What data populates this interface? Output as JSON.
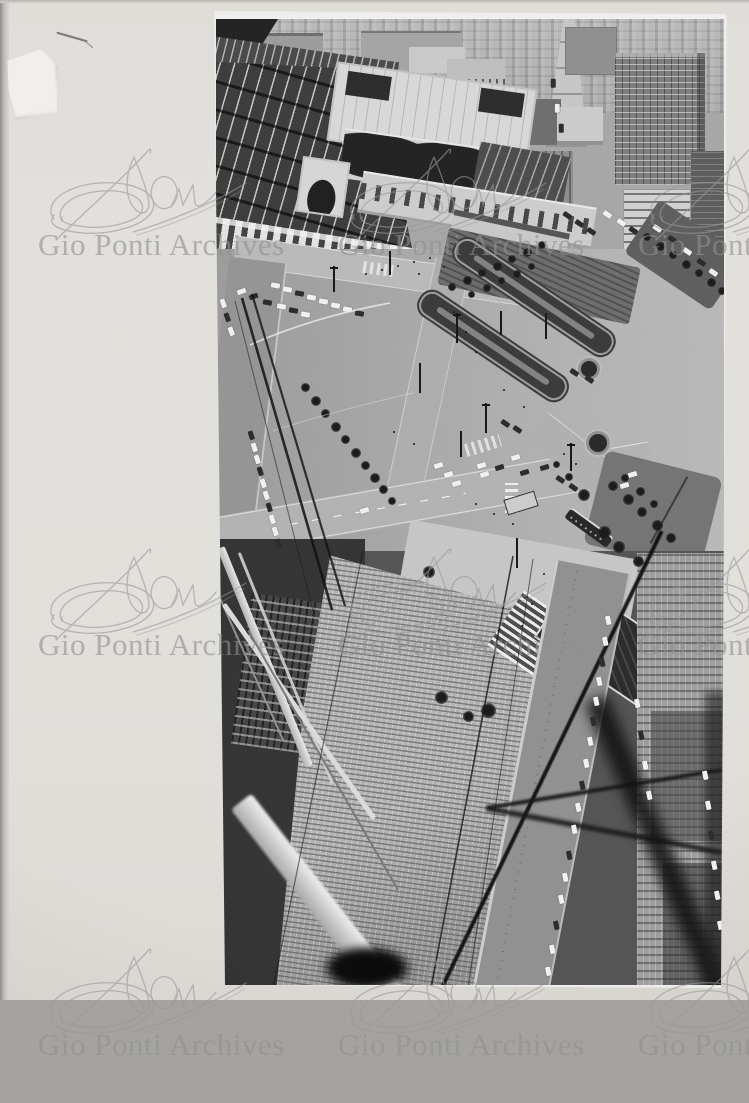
{
  "scan": {
    "mat_color": "#dad7d1",
    "mat_edge_color": "#8f8d8a",
    "background_color": "#a5a3a0"
  },
  "watermark": {
    "text": "Gio Ponti Archives",
    "color": "#8f8f8f",
    "tile_positions": [
      [
        38,
        143
      ],
      [
        338,
        143
      ],
      [
        638,
        143
      ],
      [
        38,
        543
      ],
      [
        338,
        543
      ],
      [
        638,
        543
      ],
      [
        38,
        943
      ],
      [
        338,
        943
      ],
      [
        638,
        943
      ]
    ]
  },
  "photo": {
    "alt": "Black-and-white aerial photograph looking down on Milano Centrale railway station and its forecourt square with formal garden beds, roads, tiny cars and a tram; ribbed rooftops, scaffolding beams and blurred cables cross the foreground at the bottom",
    "tones": {
      "highlight": "#ececec",
      "midtone": "#9a9a9a",
      "shadow": "#141414"
    },
    "cars": [
      [
        58,
        272,
        10,
        "l"
      ],
      [
        70,
        276,
        10,
        "l"
      ],
      [
        82,
        280,
        10,
        "d"
      ],
      [
        94,
        284,
        10,
        "l"
      ],
      [
        106,
        288,
        10,
        "l"
      ],
      [
        64,
        293,
        10,
        "l"
      ],
      [
        76,
        297,
        10,
        "d"
      ],
      [
        88,
        301,
        10,
        "l"
      ],
      [
        50,
        289,
        10,
        "d"
      ],
      [
        118,
        292,
        10,
        "l"
      ],
      [
        130,
        296,
        10,
        "l"
      ],
      [
        142,
        300,
        10,
        "d"
      ],
      [
        6,
        290,
        70,
        "l"
      ],
      [
        10,
        304,
        70,
        "d"
      ],
      [
        14,
        318,
        70,
        "l"
      ],
      [
        24,
        278,
        -20,
        "l"
      ],
      [
        36,
        283,
        -20,
        "d"
      ],
      [
        350,
        202,
        34,
        "d"
      ],
      [
        362,
        210,
        34,
        "d"
      ],
      [
        374,
        218,
        34,
        "d"
      ],
      [
        390,
        201,
        34,
        "l"
      ],
      [
        404,
        209,
        34,
        "l"
      ],
      [
        416,
        217,
        34,
        "d"
      ],
      [
        336,
        70,
        90,
        "d"
      ],
      [
        340,
        95,
        90,
        "l"
      ],
      [
        344,
        115,
        90,
        "d"
      ],
      [
        440,
        215,
        34,
        "l"
      ],
      [
        455,
        226,
        34,
        "d"
      ],
      [
        470,
        238,
        34,
        "l"
      ],
      [
        484,
        249,
        34,
        "d"
      ],
      [
        496,
        259,
        34,
        "l"
      ],
      [
        147,
        497,
        -17,
        "l"
      ],
      [
        221,
        452,
        -17,
        "l"
      ],
      [
        231,
        461,
        -17,
        "l"
      ],
      [
        239,
        470,
        -17,
        "l"
      ],
      [
        264,
        452,
        -17,
        "l"
      ],
      [
        282,
        454,
        -17,
        "d"
      ],
      [
        298,
        444,
        -17,
        "l"
      ],
      [
        307,
        459,
        -17,
        "d"
      ],
      [
        327,
        454,
        -17,
        "d"
      ],
      [
        267,
        461,
        -17,
        "l"
      ],
      [
        407,
        472,
        -17,
        "l"
      ],
      [
        415,
        461,
        -17,
        "l"
      ],
      [
        343,
        466,
        34,
        "d"
      ],
      [
        356,
        474,
        34,
        "d"
      ],
      [
        357,
        359,
        34,
        "d"
      ],
      [
        372,
        366,
        34,
        "d"
      ],
      [
        300,
        416,
        34,
        "d"
      ],
      [
        288,
        410,
        34,
        "d"
      ],
      [
        34,
        422,
        72,
        "d"
      ],
      [
        37,
        434,
        72,
        "l"
      ],
      [
        40,
        446,
        72,
        "l"
      ],
      [
        43,
        458,
        72,
        "d"
      ],
      [
        46,
        470,
        72,
        "l"
      ],
      [
        49,
        482,
        72,
        "l"
      ],
      [
        52,
        494,
        72,
        "d"
      ],
      [
        55,
        506,
        72,
        "l"
      ],
      [
        58,
        518,
        72,
        "l"
      ],
      [
        61,
        530,
        72,
        "d"
      ],
      [
        391,
        607,
        78,
        "l"
      ],
      [
        388,
        628,
        78,
        "l"
      ],
      [
        385,
        649,
        78,
        "d"
      ],
      [
        382,
        668,
        78,
        "l"
      ],
      [
        379,
        688,
        78,
        "l"
      ],
      [
        376,
        708,
        78,
        "d"
      ],
      [
        373,
        728,
        78,
        "l"
      ],
      [
        369,
        750,
        78,
        "l"
      ],
      [
        365,
        772,
        78,
        "d"
      ],
      [
        361,
        794,
        78,
        "l"
      ],
      [
        357,
        816,
        78,
        "l"
      ],
      [
        352,
        842,
        78,
        "d"
      ],
      [
        348,
        864,
        78,
        "l"
      ],
      [
        344,
        886,
        78,
        "l"
      ],
      [
        339,
        912,
        78,
        "d"
      ],
      [
        335,
        936,
        78,
        "l"
      ],
      [
        331,
        958,
        78,
        "l"
      ],
      [
        420,
        690,
        78,
        "l"
      ],
      [
        424,
        722,
        78,
        "d"
      ],
      [
        428,
        752,
        78,
        "l"
      ],
      [
        432,
        782,
        78,
        "l"
      ],
      [
        488,
        762,
        78,
        "l"
      ],
      [
        491,
        792,
        78,
        "l"
      ],
      [
        494,
        822,
        78,
        "d"
      ],
      [
        497,
        852,
        78,
        "l"
      ],
      [
        500,
        882,
        78,
        "l"
      ],
      [
        503,
        912,
        78,
        "l"
      ]
    ],
    "trees": [
      [
        235,
        272,
        8
      ],
      [
        250,
        265,
        9
      ],
      [
        265,
        258,
        8
      ],
      [
        280,
        251,
        9
      ],
      [
        295,
        244,
        8
      ],
      [
        310,
        237,
        9
      ],
      [
        325,
        230,
        8
      ],
      [
        255,
        280,
        7
      ],
      [
        270,
        273,
        8
      ],
      [
        285,
        266,
        7
      ],
      [
        300,
        259,
        8
      ],
      [
        315,
        252,
        7
      ],
      [
        430,
        222,
        8
      ],
      [
        443,
        231,
        9
      ],
      [
        456,
        240,
        8
      ],
      [
        469,
        249,
        9
      ],
      [
        482,
        258,
        8
      ],
      [
        494,
        267,
        9
      ],
      [
        505,
        276,
        8
      ],
      [
        395,
        470,
        10
      ],
      [
        410,
        483,
        11
      ],
      [
        424,
        496,
        10
      ],
      [
        439,
        509,
        11
      ],
      [
        453,
        522,
        10
      ],
      [
        408,
        463,
        8
      ],
      [
        423,
        476,
        9
      ],
      [
        437,
        489,
        8
      ],
      [
        88,
        372,
        9
      ],
      [
        98,
        385,
        10
      ],
      [
        108,
        398,
        9
      ],
      [
        118,
        411,
        10
      ],
      [
        128,
        424,
        9
      ],
      [
        138,
        437,
        10
      ],
      [
        148,
        450,
        9
      ],
      [
        157,
        462,
        10
      ],
      [
        166,
        474,
        9
      ],
      [
        175,
        486,
        8
      ],
      [
        352,
        462,
        8
      ],
      [
        340,
        450,
        7
      ],
      [
        365,
        478,
        12
      ],
      [
        385,
        515,
        13
      ],
      [
        400,
        530,
        12
      ],
      [
        420,
        545,
        11
      ],
      [
        210,
        555,
        12
      ],
      [
        268,
        692,
        15
      ],
      [
        222,
        680,
        13
      ],
      [
        250,
        700,
        11
      ]
    ],
    "people": [
      [
        152,
        262
      ],
      [
        168,
        258
      ],
      [
        184,
        254
      ],
      [
        200,
        250
      ],
      [
        216,
        246
      ],
      [
        240,
        300
      ],
      [
        252,
        320
      ],
      [
        262,
        340
      ],
      [
        180,
        420
      ],
      [
        200,
        432
      ],
      [
        262,
        492
      ],
      [
        280,
        502
      ],
      [
        299,
        512
      ],
      [
        350,
        442
      ],
      [
        362,
        452
      ],
      [
        330,
        562
      ],
      [
        318,
        592
      ],
      [
        308,
        614
      ],
      [
        230,
        255
      ],
      [
        205,
        262
      ],
      [
        290,
        378
      ],
      [
        310,
        395
      ]
    ],
    "lamp_posts": [
      [
        120,
        255,
        26,
        1
      ],
      [
        176,
        240,
        24,
        0
      ],
      [
        243,
        302,
        30,
        1
      ],
      [
        206,
        352,
        30,
        0
      ],
      [
        272,
        392,
        30,
        1
      ],
      [
        332,
        302,
        26,
        0
      ],
      [
        357,
        432,
        28,
        1
      ],
      [
        303,
        527,
        30,
        0
      ],
      [
        247,
        420,
        26,
        0
      ],
      [
        287,
        300,
        24,
        0
      ]
    ]
  }
}
